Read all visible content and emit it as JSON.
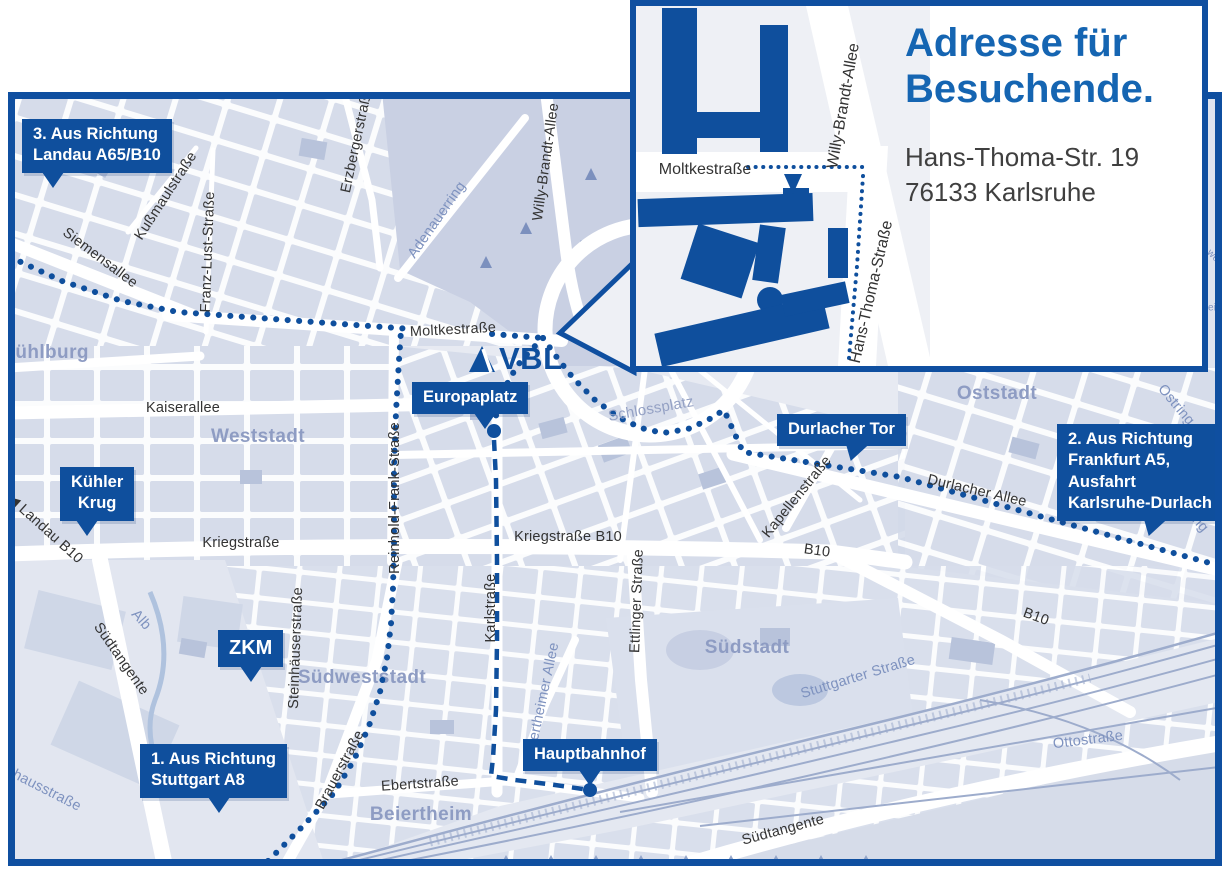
{
  "colors": {
    "primary_blue": "#0F4F9D",
    "frame_blue": "#0F4FA0",
    "title_blue": "#1565B2",
    "map_background": "#E7EAF2",
    "block_fill": "#D3DAE9",
    "park_fill": "#C9D0E3",
    "area_label": "#8E9CC3",
    "street_label": "#333333",
    "water_label": "#7E92BF"
  },
  "vbl": {
    "text": "VBL",
    "icon": "vbl-triangle-logo"
  },
  "inset": {
    "title": [
      "Adresse für",
      "Besuchende."
    ],
    "address": [
      "Hans-Thoma-Str. 19",
      "76133 Karlsruhe"
    ],
    "street_labels": [
      {
        "text": "Moltkestraße",
        "x": 69,
        "y": 164,
        "rot": 0
      },
      {
        "text": "Willy-Brandt-Allee",
        "x": 208,
        "y": 100,
        "rot": -80
      },
      {
        "text": "Hans-Thoma-Straße",
        "x": 236,
        "y": 286,
        "rot": -77
      }
    ]
  },
  "map": {
    "callouts": [
      {
        "id": "route-3-landau",
        "lines": [
          "3. Aus Richtung",
          "Landau A65/B10"
        ],
        "x": 22,
        "y": 119,
        "tail_dx": 20
      },
      {
        "id": "kuehler-krug",
        "lines": [
          "Kühler",
          "Krug"
        ],
        "x": 60,
        "y": 467,
        "tail_dx": 16,
        "center": true
      },
      {
        "id": "zkm",
        "lines": [
          "ZKM"
        ],
        "x": 218,
        "y": 630,
        "tail_dx": 22,
        "fs": 20
      },
      {
        "id": "route-1-stuttgart",
        "lines": [
          "1. Aus Richtung",
          "Stuttgart A8"
        ],
        "x": 140,
        "y": 744,
        "tail_dx": 68
      },
      {
        "id": "europaplatz",
        "lines": [
          "Europaplatz"
        ],
        "x": 412,
        "y": 382,
        "tail_dx": 62
      },
      {
        "id": "durlacher-tor",
        "lines": [
          "Durlacher Tor"
        ],
        "x": 777,
        "y": 414,
        "tail_dx": 66,
        "skew": true
      },
      {
        "id": "hauptbahnhof",
        "lines": [
          "Hauptbahnhof"
        ],
        "x": 523,
        "y": 739,
        "tail_dx": 56
      },
      {
        "id": "route-2-frankfurt",
        "lines": [
          "2. Aus Richtung",
          "Frankfurt A5,",
          "Ausfahrt",
          "Karlsruhe-Durlach"
        ],
        "x": 1057,
        "y": 424,
        "tail_dx": 84,
        "skew": true
      }
    ],
    "street_labels": [
      {
        "text": "Siemensallee",
        "x": 100,
        "y": 258,
        "rot": 37
      },
      {
        "text": "Kußmaulstraße",
        "x": 166,
        "y": 196,
        "rot": -57
      },
      {
        "text": "Franz-Lust-Straße",
        "x": 208,
        "y": 252,
        "rot": -88
      },
      {
        "text": "Erzbergerstraße",
        "x": 357,
        "y": 140,
        "rot": -78
      },
      {
        "text": "Moltkestraße",
        "x": 453,
        "y": 330,
        "rot": -3
      },
      {
        "text": "Adenauerring",
        "x": 437,
        "y": 220,
        "rot": -55,
        "cls": "blue"
      },
      {
        "text": "Willy-Brandt-Allee",
        "x": 546,
        "y": 162,
        "rot": -82
      },
      {
        "text": "Kaiserallee",
        "x": 183,
        "y": 408,
        "rot": 0
      },
      {
        "text": "◀ Landau B10",
        "x": 45,
        "y": 529,
        "rot": 42
      },
      {
        "text": "Kriegstraße",
        "x": 241,
        "y": 543,
        "rot": 0
      },
      {
        "text": "Reinhold-Frank-Straße",
        "x": 395,
        "y": 498,
        "rot": -90
      },
      {
        "text": "Kriegstraße B10",
        "x": 568,
        "y": 537,
        "rot": 0
      },
      {
        "text": "Karlstraße",
        "x": 491,
        "y": 608,
        "rot": -90
      },
      {
        "text": "Ettlinger Straße",
        "x": 637,
        "y": 601,
        "rot": -88
      },
      {
        "text": "Beiertheimer Allee",
        "x": 542,
        "y": 702,
        "rot": -78,
        "cls": "blue"
      },
      {
        "text": "Schlossplatz",
        "x": 651,
        "y": 409,
        "rot": -10,
        "cls": "bluegray"
      },
      {
        "text": "Kapellenstraße",
        "x": 797,
        "y": 497,
        "rot": -51
      },
      {
        "text": "Durlacher Allee",
        "x": 977,
        "y": 491,
        "rot": 13
      },
      {
        "text": "B10",
        "x": 817,
        "y": 551,
        "rot": 8
      },
      {
        "text": "B10",
        "x": 1036,
        "y": 617,
        "rot": 20
      },
      {
        "text": "Ostring",
        "x": 1176,
        "y": 405,
        "rot": 50,
        "cls": "blue"
      },
      {
        "text": "Ostring",
        "x": 1190,
        "y": 512,
        "rot": 50,
        "cls": "blue"
      },
      {
        "text": "Stuttgarter Straße",
        "x": 858,
        "y": 677,
        "rot": -17,
        "cls": "blue"
      },
      {
        "text": "Ottostraße",
        "x": 1088,
        "y": 740,
        "rot": -7,
        "cls": "blue"
      },
      {
        "text": "Südtangente",
        "x": 783,
        "y": 830,
        "rot": -15
      },
      {
        "text": "Südtangente",
        "x": 121,
        "y": 659,
        "rot": 55
      },
      {
        "text": "Alb",
        "x": 141,
        "y": 620,
        "rot": 48,
        "cls": "blue"
      },
      {
        "text": "Steinhäuserstraße",
        "x": 296,
        "y": 648,
        "rot": -88
      },
      {
        "text": "Brauerstraße",
        "x": 340,
        "y": 770,
        "rot": -62
      },
      {
        "text": "Ebertstraße",
        "x": 420,
        "y": 784,
        "rot": -4
      },
      {
        "text": "Pulverhausstraße",
        "x": 28,
        "y": 781,
        "rot": 27,
        "cls": "blue"
      },
      {
        "text": "we",
        "x": 1213,
        "y": 256,
        "rot": 45,
        "cls": "blue tiny"
      },
      {
        "text": "ein",
        "x": 1215,
        "y": 308,
        "rot": 0,
        "cls": "blue tiny"
      }
    ],
    "area_labels": [
      {
        "text": "Mühlburg",
        "x": 44,
        "y": 353
      },
      {
        "text": "Weststadt",
        "x": 258,
        "y": 437
      },
      {
        "text": "Oststadt",
        "x": 997,
        "y": 394
      },
      {
        "text": "Südstadt",
        "x": 747,
        "y": 648
      },
      {
        "text": "Südweststadt",
        "x": 362,
        "y": 678
      },
      {
        "text": "Beiertheim",
        "x": 421,
        "y": 815
      }
    ]
  }
}
